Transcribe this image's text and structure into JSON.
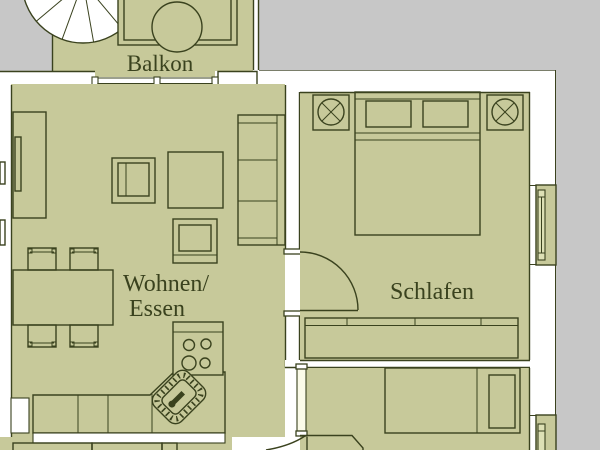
{
  "plan": {
    "rooms": [
      {
        "id": "balkon",
        "label": "Balkon"
      },
      {
        "id": "wohnen-essen",
        "label_line1": "Wohnen/",
        "label_line2": "Essen"
      },
      {
        "id": "schlafen",
        "label": "Schlafen"
      }
    ],
    "colors": {
      "floor": "#c7c99a",
      "outside": "#c7c7c7",
      "wall": "#ffffff",
      "line": "#3a421e",
      "text": "#3a421e",
      "door_leaf": "#fbfbe9",
      "pane": "#dde0b5"
    }
  }
}
